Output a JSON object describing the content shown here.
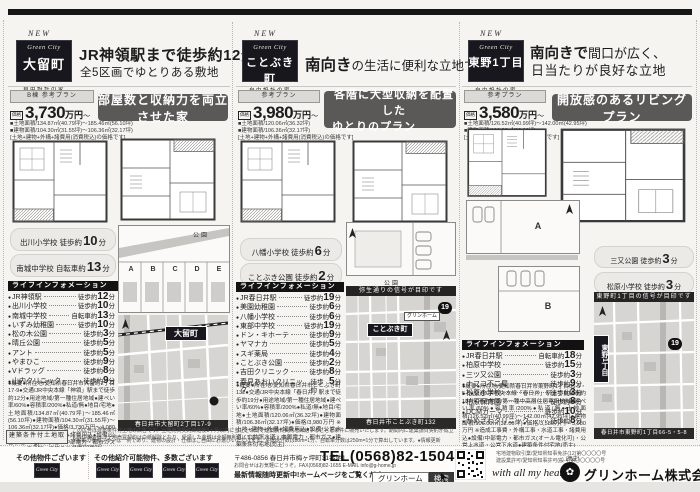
{
  "page": {
    "min_unit": "分"
  },
  "listings": [
    {
      "new_label": "NEW",
      "brand": "Green City",
      "town": "大留町",
      "logo_sub1": "自由設計の家",
      "logo_sub2": "分譲住宅",
      "headline_strong": "JR神領駅まで徒歩約12分",
      "headline_rest": "",
      "headline_line2": "全5区画でゆとりある敷地",
      "plan_tag": "B棟 参考プラン",
      "price_label": "価格",
      "price": "3,730",
      "price_unit": "万円",
      "price_tilde": "〜",
      "spec_lines": [
        "■土地面積/134.87㎡(40.79坪)〜185.46㎡(56.10坪)",
        "■建物面積/104.30㎡(31.55坪)〜106.36㎡(32.17坪)",
        "[土地+建物+外構+諸費用(消費税込)の価格です]"
      ],
      "catch1": "部屋数と収納力を両立させた家",
      "catch2": "",
      "badge1": {
        "place": "出川小学校",
        "mode": "徒歩約",
        "min": "10"
      },
      "badge2": {
        "place": "南城中学校",
        "mode": "自転車約",
        "min": "13"
      },
      "life_title": "ライフインフォメーション",
      "life": [
        {
          "place": "JR神領駅",
          "mode": "徒歩約",
          "min": "12"
        },
        {
          "place": "出川小学校",
          "mode": "徒歩約",
          "min": "10"
        },
        {
          "place": "南城中学校",
          "mode": "自転車約",
          "min": "13"
        },
        {
          "place": "いずみ幼稚園",
          "mode": "徒歩約",
          "min": "10"
        },
        {
          "place": "松の木公園",
          "mode": "徒歩約",
          "min": "3"
        },
        {
          "place": "晴丘公園",
          "mode": "徒歩約",
          "min": "5"
        },
        {
          "place": "アント",
          "mode": "徒歩約",
          "min": "5"
        },
        {
          "place": "やまひこ",
          "mode": "徒歩約",
          "min": "9"
        },
        {
          "place": "Vドラッグ",
          "mode": "徒歩約",
          "min": "8"
        },
        {
          "place": "山内クリニック",
          "mode": "徒歩約",
          "min": "9"
        }
      ],
      "outline": "●概要●所在地/愛知県春日井市大留町2丁目17-9●交通/JR中央本線「神領」駅まで徒歩約12分●用途地域/第一種住居地域●建ぺい率/60%●容積率/200%●私道/無●地目/宅地●土地面積/134.87㎡(40.79坪)〜185.46㎡(56.10坪)●建物面積/104.30㎡(31.55坪)〜106.36㎡(32.17坪)●価格/3,730万円〜4,080万円 ※土地+建物+外構+諸費用込●設備/公営水道・公共下水道・中部電力・都市ガス(オール電化可)●建築条件付宅地(売主)",
      "site_park": "公園",
      "lots": [
        "A",
        "B",
        "C",
        "D",
        "E"
      ],
      "map_header": "",
      "map_pin": "大留町",
      "map_company": "",
      "map_route": "",
      "map_caption": "春日井市大留町2丁目17-9"
    },
    {
      "new_label": "NEW",
      "brand": "Green City",
      "town": "ことぶき町",
      "logo_sub1": "自由設計の家",
      "logo_sub2": "",
      "headline_strong": "南向き",
      "headline_rest": "の生活に便利な立地です。",
      "headline_line2": "",
      "plan_tag": "参考プラン",
      "price_label": "価格",
      "price": "3,980",
      "price_unit": "万円",
      "price_tilde": "〜",
      "spec_lines": [
        "■土地面積/120.06㎡(36.32坪)",
        "■建物面積/106.36㎡(32.17坪)",
        "[土地+建物+外構+諸費用(消費税込)の価格です]"
      ],
      "catch1": "各階に大型収納を配置した",
      "catch2": "ゆとりのプラン",
      "badge1": {
        "place": "八幡小学校",
        "mode": "徒歩約",
        "min": "6"
      },
      "badge2": {
        "place": "ことぶき公園",
        "mode": "徒歩約",
        "min": "2"
      },
      "life_title": "ライフインフォメーション",
      "life": [
        {
          "place": "JR春日井駅",
          "mode": "徒歩約",
          "min": "19"
        },
        {
          "place": "美園幼稚園",
          "mode": "徒歩約",
          "min": "6"
        },
        {
          "place": "八幡小学校",
          "mode": "徒歩約",
          "min": "6"
        },
        {
          "place": "東部中学校",
          "mode": "徒歩約",
          "min": "19"
        },
        {
          "place": "ドン・キホーテ",
          "mode": "徒歩約",
          "min": "9"
        },
        {
          "place": "ヤマナカ",
          "mode": "徒歩約",
          "min": "5"
        },
        {
          "place": "スギ薬局",
          "mode": "徒歩約",
          "min": "4"
        },
        {
          "place": "ことぶき公園",
          "mode": "徒歩約",
          "min": "2"
        },
        {
          "place": "吉田クリニック",
          "mode": "徒歩約",
          "min": "8"
        },
        {
          "place": "春見あおいクリニック",
          "mode": "徒歩約",
          "min": "5"
        }
      ],
      "outline": "●概要●所在地/愛知県春日井市ことぶき町132●交通/JR中央本線「春日井」駅まで徒歩約19分●用途地域/第一種住居地域●建ぺい率/60%●容積率/200%●私道/無●地目/宅地●土地面積/120.06㎡(36.32坪)●建物面積/106.36㎡(32.17坪)●価格/3,980万円 ※土地+建物+外構+諸費用込●設備/公営水道・公共下水道・中部電力・都市ガス●建築条件付宅地(売主)",
      "site_park": "公園",
      "lots": [],
      "map_header": "弥生通りの信号が目印です",
      "map_pin": "ことぶき町",
      "map_company": "グリンホーム",
      "map_route": "19",
      "map_caption": "春日井市ことぶき町132"
    },
    {
      "new_label": "NEW",
      "brand": "Green City",
      "town": "東野1丁目",
      "logo_sub1": "自由設計の家",
      "logo_sub2": "",
      "headline_strong": "南向きで",
      "headline_rest": "間口が広く、",
      "headline_line2": "日当たりが良好な立地",
      "plan_tag": "参考プラン",
      "price_label": "価格",
      "price": "3,580",
      "price_unit": "万円",
      "price_tilde": "〜",
      "spec_lines": [
        "■土地面積/126.52㎡(40.99坪)〜142.00㎡(42.95坪)",
        "■建物面積/106.00㎡(32.06坪)",
        "[土地+建物+外構+諸費用込の価格です]"
      ],
      "catch1": "開放感のあるリビングプラン",
      "catch2": "",
      "badge1": {
        "place": "三又公園",
        "mode": "徒歩約",
        "min": "3"
      },
      "badge2": {
        "place": "松原小学校",
        "mode": "徒歩約",
        "min": "3"
      },
      "life_title": "ライフインフォメーション",
      "life": [
        {
          "place": "JR春日井駅",
          "mode": "自転車約",
          "min": "18"
        },
        {
          "place": "柏原中学校",
          "mode": "徒歩約",
          "min": "15"
        },
        {
          "place": "三ツ又公園",
          "mode": "徒歩約",
          "min": "3"
        },
        {
          "place": "ナフコ不二屋",
          "mode": "徒歩約",
          "min": "9"
        },
        {
          "place": "松原小学校",
          "mode": "徒歩約",
          "min": "3"
        },
        {
          "place": "柏原保育園",
          "mode": "徒歩約",
          "min": "8"
        },
        {
          "place": "DCMカーマ",
          "mode": "徒歩約",
          "min": "10"
        },
        {
          "place": "かめざわクリニック",
          "mode": "徒歩約",
          "min": "8"
        }
      ],
      "outline": "●概要●所在地/愛知県春日井市東野町1丁目66-5・5-8●交通/JR中央本線「春日井」駅まで自転車約18分●用途地域/第一種中高層住居専用地域●建ぺい率/60%●容積率/200%●私道/無●土地面積/126.52㎡(40.99坪)〜142.00㎡(42.95坪)●建物面積/106.00㎡(32.06坪)●価格/3,580万円〜3,980万円 ※造成工事費・外構工事・水道工事・諸費用込●設備/中部電力・都市ガス(オール電化可)・公営上水道・公営下水道●建築条件付宅地(売主)",
      "site_park": "",
      "lots": [
        "A",
        "B"
      ],
      "map_header": "東野町1丁目の信号が目印です",
      "map_pin": "東野1丁目",
      "map_company": "",
      "map_route": "19",
      "map_caption": "春日井市東野町1丁目66-5・5-8"
    }
  ],
  "legal": {
    "badge": "建築条件付土地取引",
    "disclaimer1": "この広告は建築条件付土地の広告です。土地売買契約締結後3ヶ月以内に当社との間で建築請負契約を締結することを条件に販売いたします。期間内に建築請負契約が成立しない場合は、土地売買契約は白紙解除となり、受領した金銭は全額無利息にてお返しいたします。",
    "disclaimer2": "※掲載の参考プランは一例であり、建物の設計・仕様はご自由にお選びいただけます。※徒歩分数は80m=1分、自転車分数は250m=1分で算出しています。●情報更新日/2023年3月"
  },
  "bottom": {
    "others1_title": "その他物件ございます",
    "others2_title": "その他紹介可能物件、多数ございます",
    "tile_brand": "Green City",
    "address_zip": "〒486-0856",
    "address": "春日井市梅ヶ坪町31番地1",
    "tel": "TEL(0568)82-1504",
    "contact_sub": "お問合せはお気軽にどうぞ。FAX(0568)82-1655 E-MAIL info@g-home.jp",
    "hp_note": "最新情報随時更新中!ホームページをご覧ください!!",
    "search_word": "グリンホーム",
    "search_btn": "検索",
    "license1": "宅地建物取引業/愛知県知事免許(12)第〇〇〇〇号",
    "license2": "建設業許可/愛知県知事許可(般-4)第〇〇〇〇〇号",
    "seller_note": "(売主)",
    "slogan": "with all my heart",
    "company": "グリンホーム株式会社"
  }
}
